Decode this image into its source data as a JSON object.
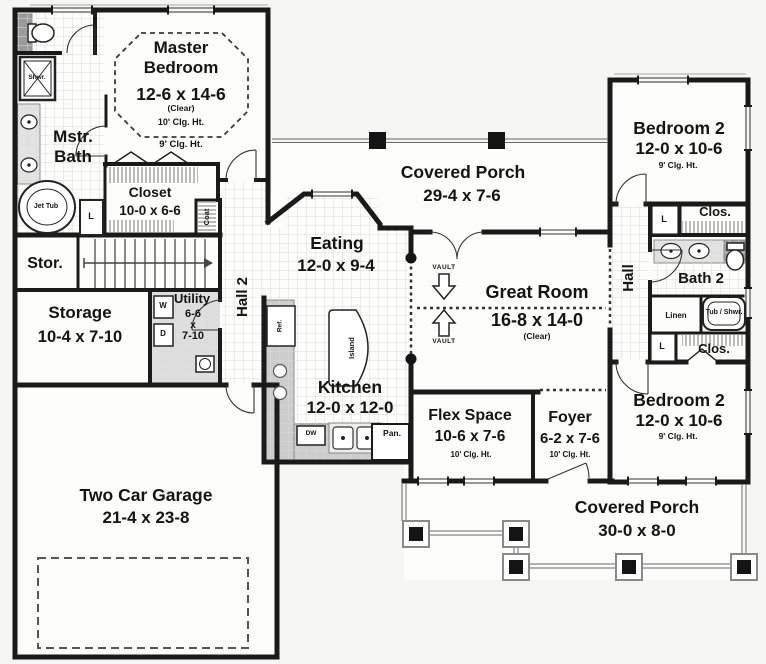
{
  "colors": {
    "wall": "#1a1a1a",
    "tile_line": "#d9d9d9",
    "counter_gray": "#cdcdcd",
    "dash": "#3a3a3a",
    "column_black": "#141414"
  },
  "rooms": {
    "master_bedroom": {
      "name": "Master Bedroom",
      "dims": "12-6 x 14-6",
      "note": "(Clear)",
      "ceiling": "10' Clg. Ht.",
      "ceiling2": "9' Clg. Ht."
    },
    "master_bath": {
      "name": "Mstr. Bath"
    },
    "closet": {
      "name": "Closet",
      "dims": "10-0 x 6-6"
    },
    "stor": {
      "name": "Stor."
    },
    "storage": {
      "name": "Storage",
      "dims": "10-4 x 7-10"
    },
    "utility": {
      "name": "Utility",
      "d1": "6-6",
      "d2": "x",
      "d3": "7-10"
    },
    "hall2": {
      "name": "Hall 2"
    },
    "garage": {
      "name": "Two Car Garage",
      "dims": "21-4 x 23-8"
    },
    "eating": {
      "name": "Eating",
      "dims": "12-0 x 9-4"
    },
    "kitchen": {
      "name": "Kitchen",
      "dims": "12-0 x 12-0"
    },
    "covered_porch_rear": {
      "name": "Covered Porch",
      "dims": "29-4 x 7-6"
    },
    "great_room": {
      "name": "Great Room",
      "dims": "16-8 x 14-0",
      "note": "(Clear)"
    },
    "flex_space": {
      "name": "Flex Space",
      "dims": "10-6 x 7-6",
      "ceiling": "10' Clg. Ht."
    },
    "foyer": {
      "name": "Foyer",
      "dims": "6-2 x 7-6",
      "ceiling": "10' Clg. Ht."
    },
    "bedroom2_upper": {
      "name": "Bedroom 2",
      "dims": "12-0 x 10-6",
      "ceiling": "9' Clg. Ht."
    },
    "bedroom2_lower": {
      "name": "Bedroom 2",
      "dims": "12-0 x 10-6",
      "ceiling": "9' Clg. Ht."
    },
    "hall": {
      "name": "Hall"
    },
    "bath2": {
      "name": "Bath 2"
    },
    "covered_porch_front": {
      "name": "Covered Porch",
      "dims": "30-0 x 8-0"
    }
  },
  "fixtures": {
    "shower": "Shwr.",
    "jet_tub": "Jet Tub",
    "linen_l": "L",
    "coat": "Coat",
    "washer": "W",
    "dryer": "D",
    "refrigerator": "Ref.",
    "island": "Island",
    "dishwasher": "DW",
    "pantry": "Pan.",
    "linen": "Linen",
    "tub_shower": "Tub / Shwr.",
    "closet_abbr": "Clos.",
    "vault": "VAULT"
  }
}
